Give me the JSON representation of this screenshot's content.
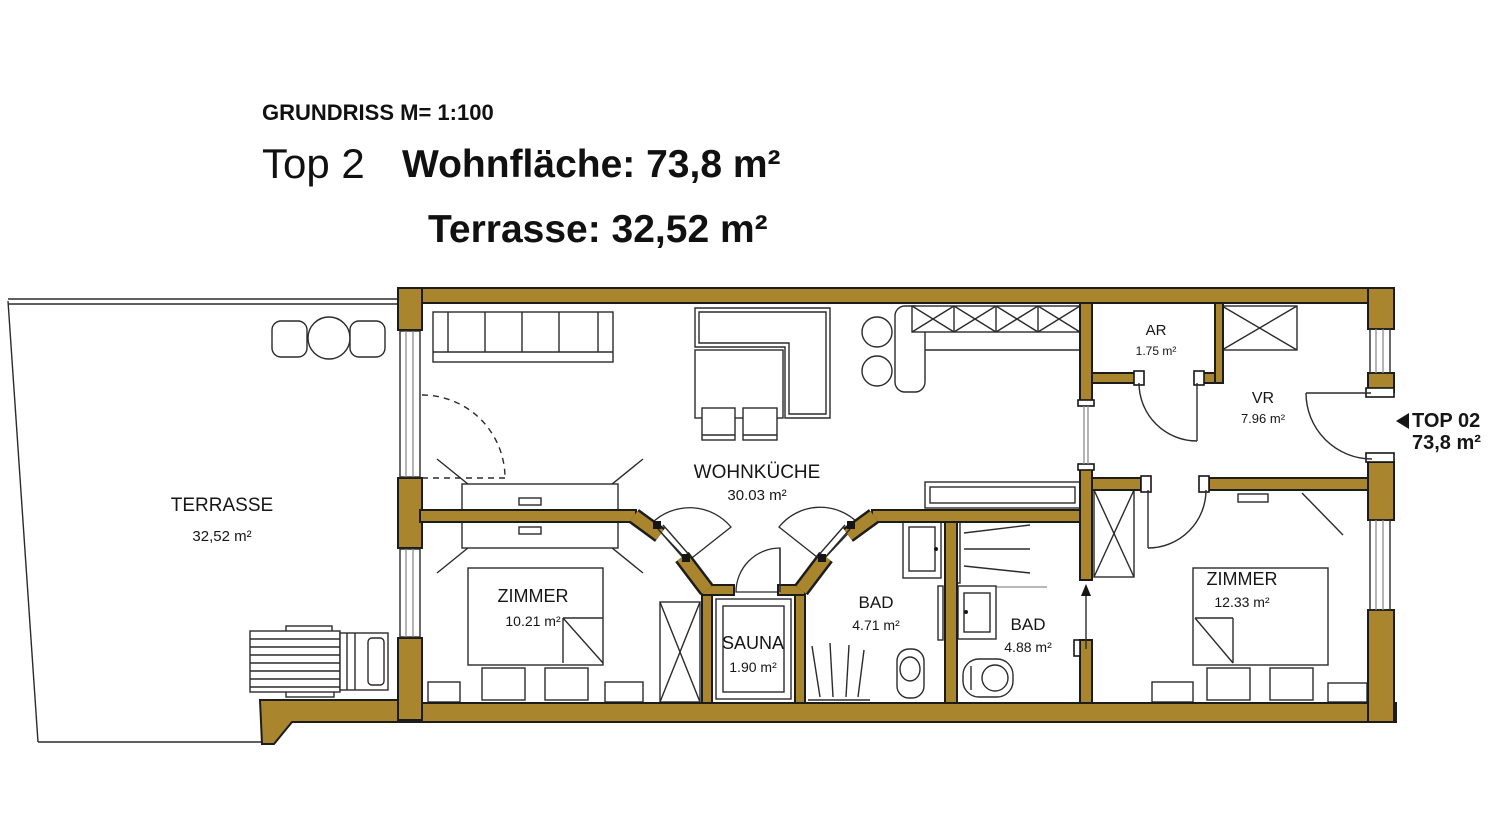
{
  "header": {
    "scale": "GRUNDRISS M= 1:100",
    "unit": "Top 2",
    "living": "Wohnfläche: 73,8 m²",
    "terrace": "Terrasse: 32,52 m²"
  },
  "rooms": [
    {
      "name": "TERRASSE",
      "area": "32,52 m²"
    },
    {
      "name": "WOHNKÜCHE",
      "area": "30.03 m²"
    },
    {
      "name": "ZIMMER",
      "area": "10.21 m²"
    },
    {
      "name": "SAUNA",
      "area": "1.90 m²"
    },
    {
      "name": "BAD",
      "area": "4.71 m²"
    },
    {
      "name": "BAD",
      "area": "4.88 m²"
    },
    {
      "name": "AR",
      "area": "1.75 m²"
    },
    {
      "name": "VR",
      "area": "7.96 m²"
    },
    {
      "name": "ZIMMER",
      "area": "12.33 m²"
    }
  ],
  "entrance": {
    "label": "TOP 02",
    "area": "73,8 m²"
  },
  "colors": {
    "wall_fill": "#A9852E",
    "outline": "#1c1c1c",
    "background": "#ffffff",
    "text": "#161616"
  }
}
